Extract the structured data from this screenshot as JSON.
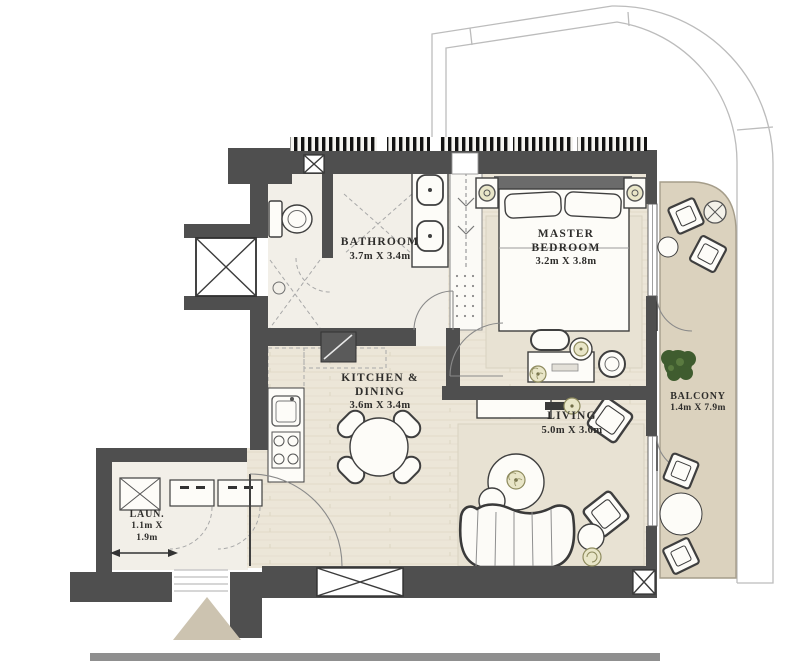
{
  "rooms": {
    "bathroom": {
      "name": "BATHROOM",
      "dims": "3.7m X 3.4m"
    },
    "master_bedroom": {
      "name_line1": "MASTER",
      "name_line2": "BEDROOM",
      "dims": "3.2m X 3.8m"
    },
    "kitchen_dining": {
      "name_line1": "KITCHEN &",
      "name_line2": "DINING",
      "dims": "3.6m X 3.4m"
    },
    "living": {
      "name": "LIVING",
      "dims": "5.0m X 3.6m"
    },
    "balcony": {
      "name": "BALCONY",
      "dims": "1.4m X 7.9m"
    },
    "laundry": {
      "name": "LAUN.",
      "dims_line1": "1.1m X",
      "dims_line2": "1.9m"
    }
  },
  "colors": {
    "wall": "#4f4f4f",
    "hatch": "#121212",
    "floor_wood": "#ece6d8",
    "floor_tile": "#f2efe8",
    "rug": "#e8e2d3",
    "balcony_floor": "#dbd2be",
    "entrance_arrow": "#ccc3b0",
    "plant": "#3f5c2f",
    "accent": "#b5b283",
    "outline": "#bcbcbc"
  }
}
